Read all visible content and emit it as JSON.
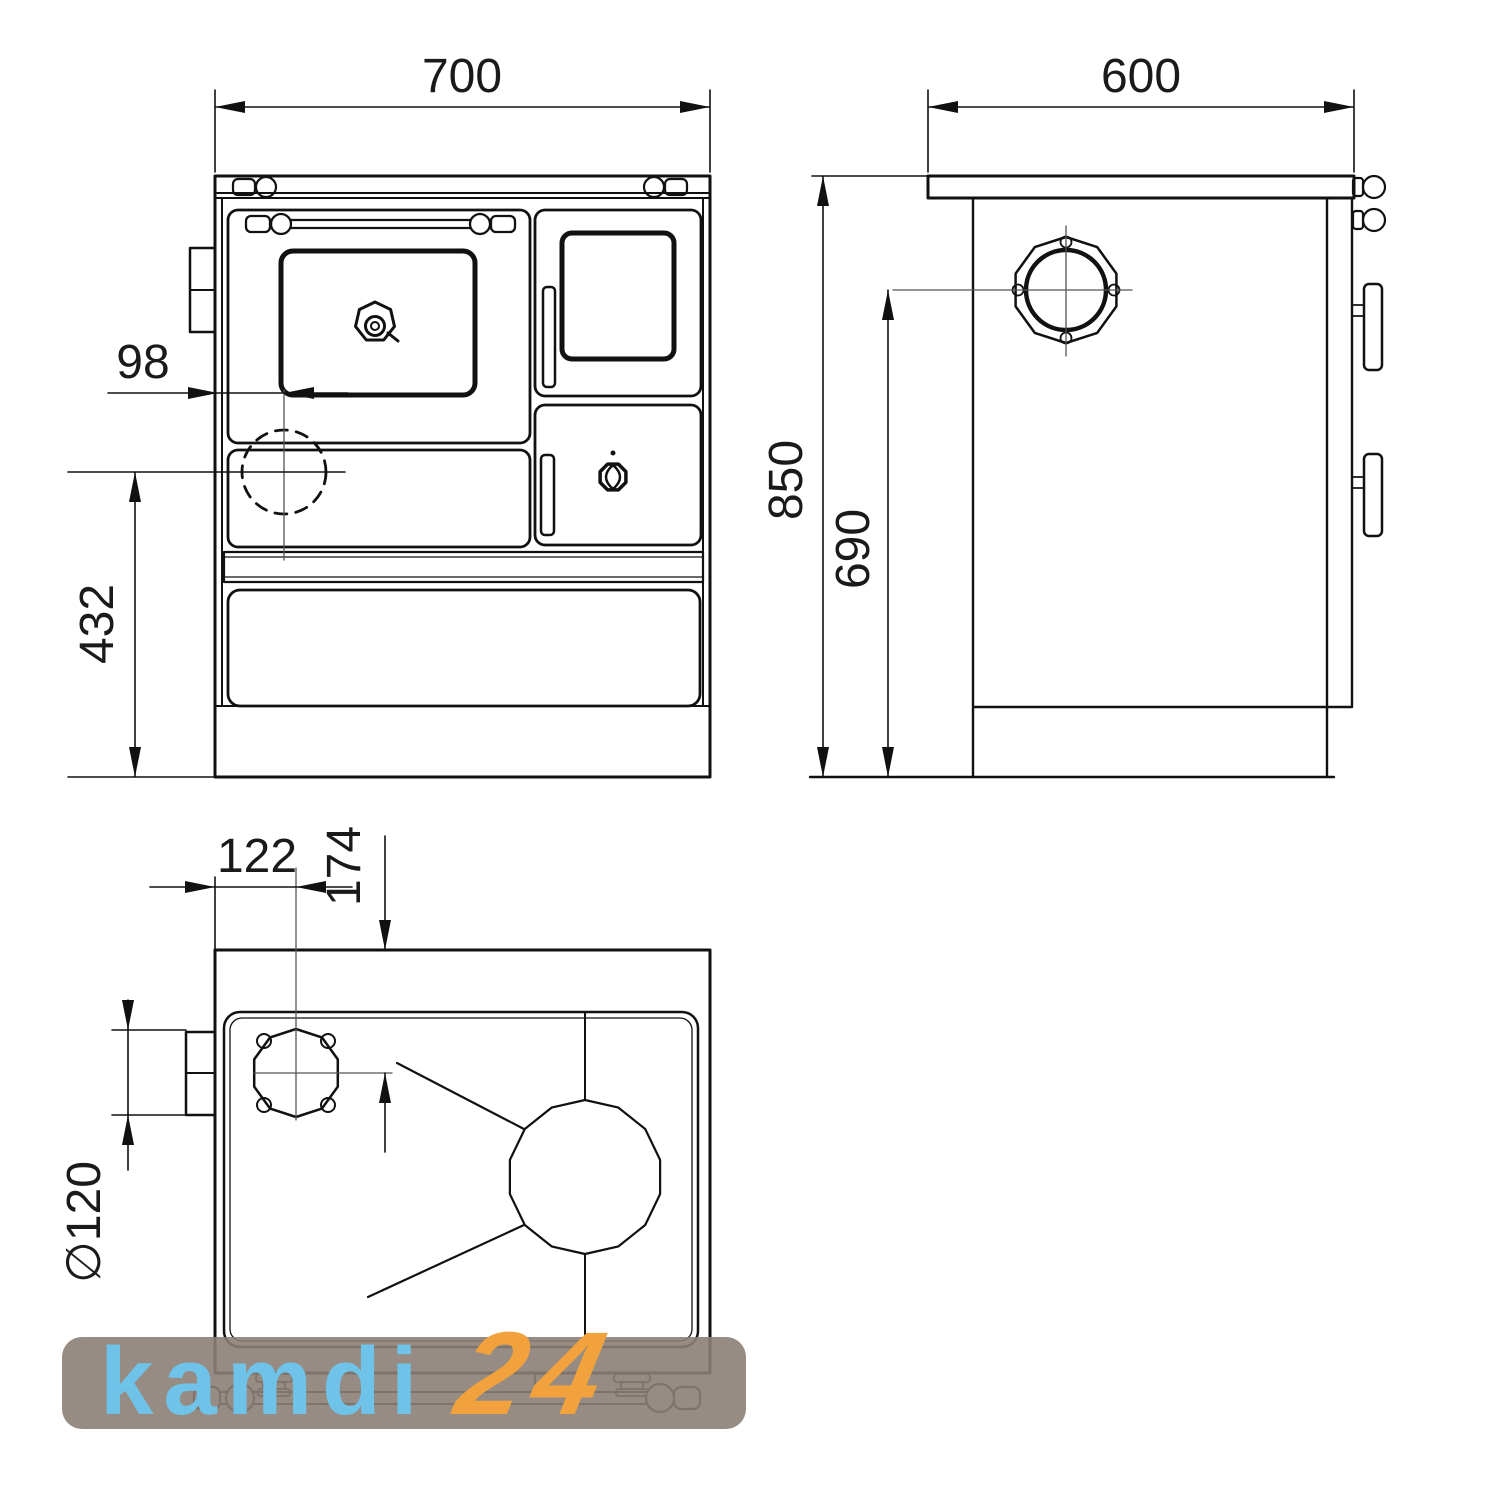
{
  "dims": {
    "front_width": "700",
    "front_flue_offset": "98",
    "front_flue_height": "432",
    "side_depth": "600",
    "side_height": "850",
    "side_flue_center_height": "690",
    "top_flue_offset_x": "122",
    "top_flue_offset_y": "174",
    "top_flue_diameter": "∅120"
  },
  "watermark": {
    "brand": "kamdi",
    "number": "24",
    "brand_color": "#6fc3e9",
    "number_color": "#f2a23d",
    "bg_color": "rgba(139,127,117,0.9)"
  },
  "colors": {
    "line": "#111111",
    "centerline": "#555555",
    "background": "#ffffff"
  }
}
